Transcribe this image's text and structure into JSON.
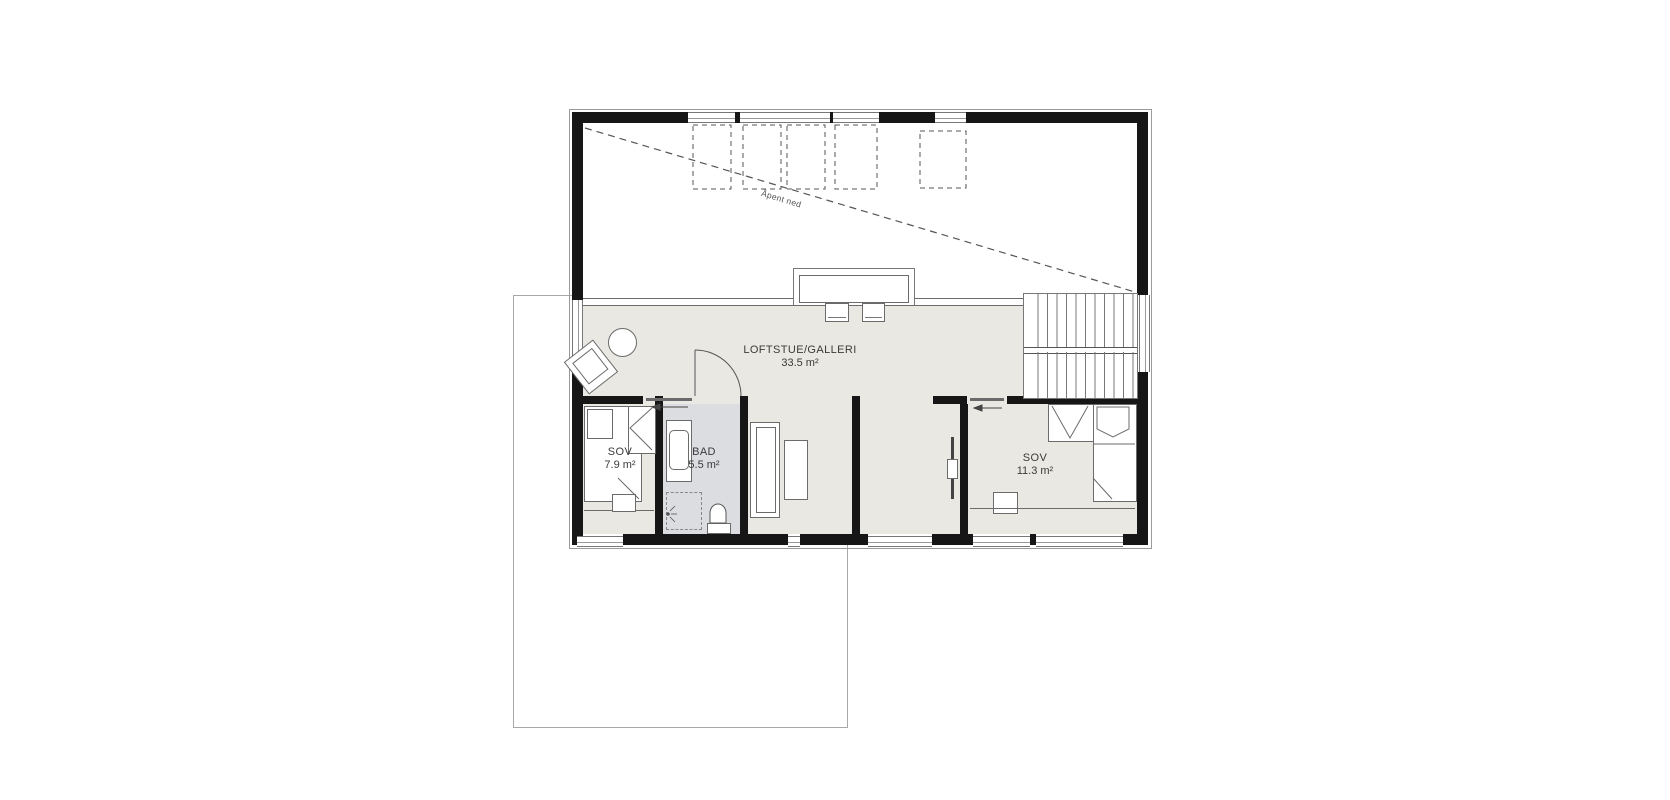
{
  "plan": {
    "rooms": {
      "loft": {
        "name": "LOFTSTUE/GALLERI",
        "area": "33.5 m²"
      },
      "bedroom_small": {
        "name": "SOV",
        "area": "7.9 m²"
      },
      "bathroom": {
        "name": "BAD",
        "area": "5.5 m²"
      },
      "bedroom_large": {
        "name": "SOV",
        "area": "11.3 m²"
      }
    },
    "annotations": {
      "open_to_below": "Åpent ned"
    },
    "colors": {
      "wall": "#161616",
      "floor": "#e9e8e2",
      "bathroom_floor": "#dbdde0",
      "outline_below": "#9a9a9a",
      "detail_line": "#6b6b6b"
    }
  }
}
